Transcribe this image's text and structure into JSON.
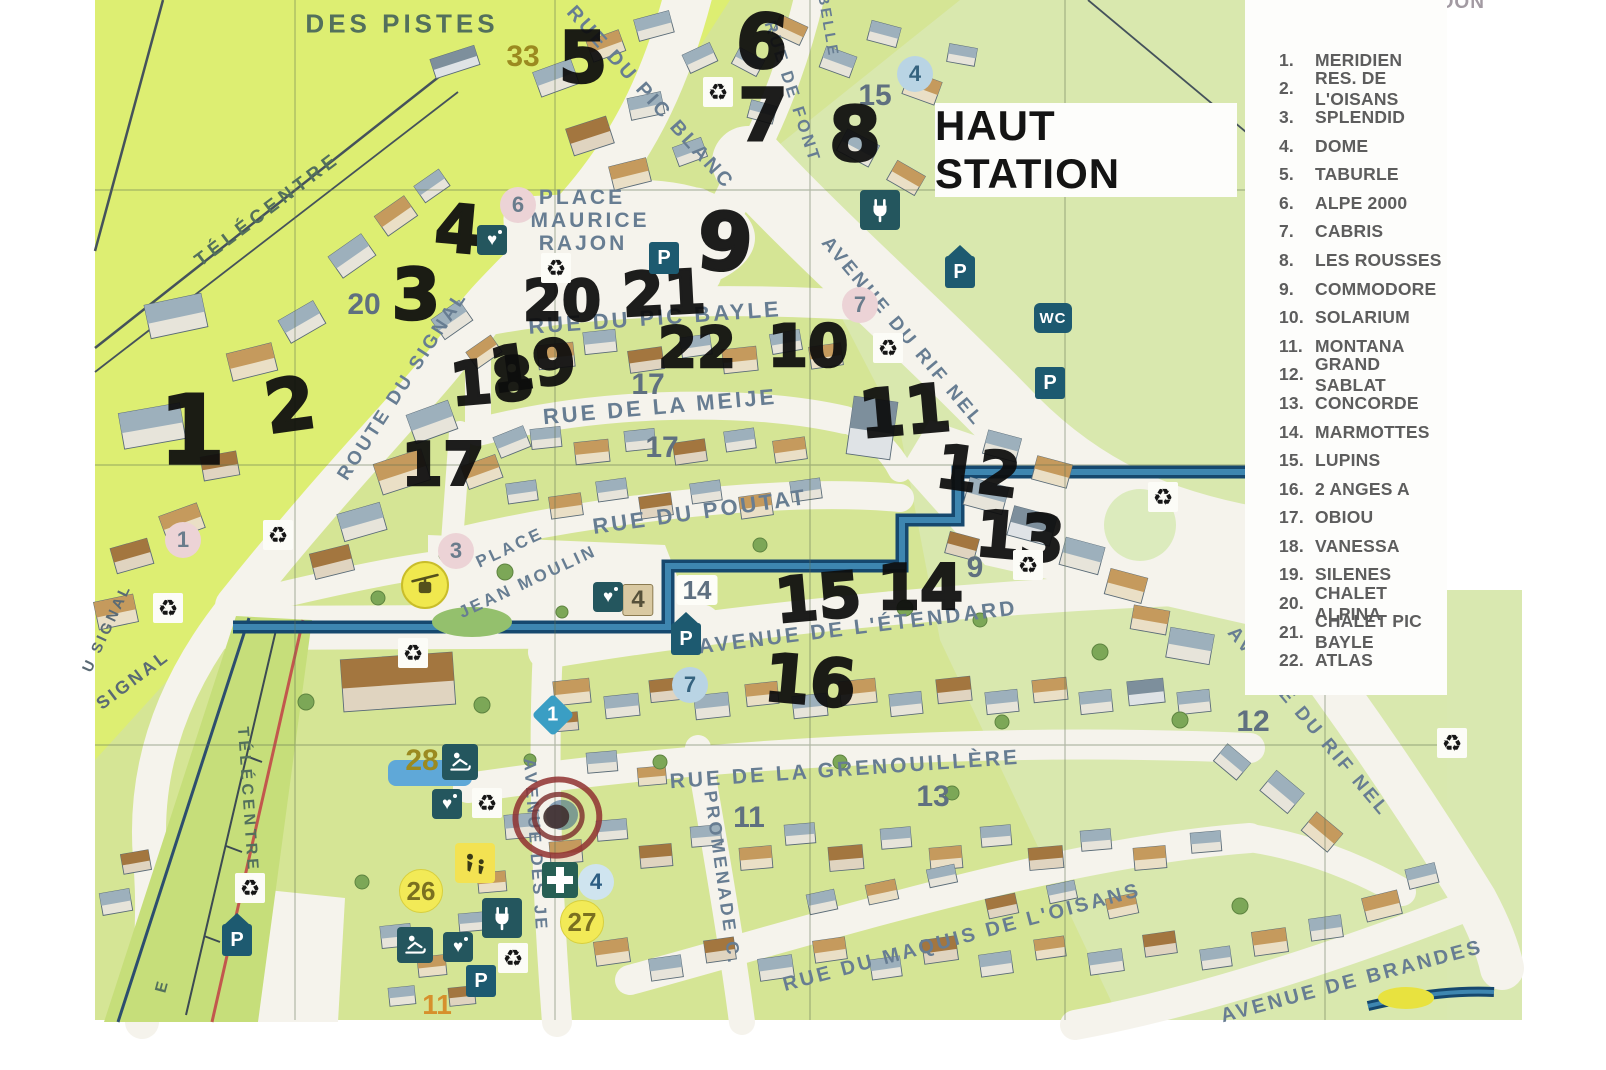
{
  "title": {
    "text": "HAUT STATION"
  },
  "agency": {
    "name": "AGENCE GIVERDON"
  },
  "legend": {
    "items": [
      {
        "n": "1.",
        "label": "MERIDIEN"
      },
      {
        "n": "2.",
        "label": "RES. DE L'OISANS"
      },
      {
        "n": "3.",
        "label": "SPLENDID"
      },
      {
        "n": "4.",
        "label": "DOME"
      },
      {
        "n": "5.",
        "label": "TABURLE"
      },
      {
        "n": "6.",
        "label": "ALPE 2000"
      },
      {
        "n": "7.",
        "label": "CABRIS"
      },
      {
        "n": "8.",
        "label": "LES ROUSSES"
      },
      {
        "n": "9.",
        "label": "COMMODORE"
      },
      {
        "n": "10.",
        "label": "SOLARIUM"
      },
      {
        "n": "11.",
        "label": "MONTANA"
      },
      {
        "n": "12.",
        "label": "GRAND SABLAT"
      },
      {
        "n": "13.",
        "label": "CONCORDE"
      },
      {
        "n": "14.",
        "label": "MARMOTTES"
      },
      {
        "n": "15.",
        "label": "LUPINS"
      },
      {
        "n": "16.",
        "label": "2 ANGES A"
      },
      {
        "n": "17.",
        "label": "OBIOU"
      },
      {
        "n": "18.",
        "label": "VANESSA"
      },
      {
        "n": "19.",
        "label": "SILENES"
      },
      {
        "n": "20.",
        "label": "CHALET ALPINA"
      },
      {
        "n": "21.",
        "label": "CHALET PIC BAYLE"
      },
      {
        "n": "22.",
        "label": "ATLAS"
      }
    ]
  },
  "labels": {
    "des_pistes": "DES PISTES",
    "telecentre_top": "TÉLÉCENTRE",
    "pic_blanc": "RUE DU PIC BLANC",
    "font": "RUE DE FONT",
    "belle": "BELLE",
    "rajon1": "PLACE",
    "rajon2": "MAURICE",
    "rajon3": "RAJON",
    "pic_bayle": "RUE DU PIC BAYLE",
    "signal": "ROUTE DU SIGNAL",
    "rifnel_upper": "AVENUE DU RIF NEL",
    "meije": "RUE DE LA MEIJE",
    "poutat": "RUE DU POUTAT",
    "jm1": "PLACE",
    "jm2": "JEAN MOULIN",
    "etendard": "AVENUE DE L'ÉTENDARD",
    "rifnel_right": "AVENUE DU RIF NEL",
    "grenouillere": "RUE DE LA GRENOUILLÈRE",
    "promenade": "PROMENADE C.",
    "jeux": "AVENUE DES JE",
    "maquis": "RUE DU MAQUIS DE L'OISANS",
    "brandes": "AVENUE DE BRANDES",
    "telecentre_v": "TÉLÉCENTRE",
    "signal_bl": "SIGNAL",
    "signal_left": "U SIGNAL",
    "e": "E"
  },
  "icon_labels": {
    "parking": "P",
    "wc": "WC"
  },
  "printed": [
    {
      "t": "33"
    },
    {
      "t": "4"
    },
    {
      "t": "15"
    },
    {
      "t": "6"
    },
    {
      "t": "20"
    },
    {
      "t": "7"
    },
    {
      "t": "17"
    },
    {
      "t": "17"
    },
    {
      "t": "1"
    },
    {
      "t": "3"
    },
    {
      "t": "9"
    },
    {
      "t": "14"
    },
    {
      "t": "4"
    },
    {
      "t": "7"
    },
    {
      "t": "1"
    },
    {
      "t": "12"
    },
    {
      "t": "28"
    },
    {
      "t": "13"
    },
    {
      "t": "11"
    },
    {
      "t": "26"
    },
    {
      "t": "4"
    },
    {
      "t": "27"
    },
    {
      "t": "11"
    }
  ],
  "hand": [
    {
      "t": "1"
    },
    {
      "t": "2"
    },
    {
      "t": "3"
    },
    {
      "t": "4"
    },
    {
      "t": "5"
    },
    {
      "t": "6"
    },
    {
      "t": "7"
    },
    {
      "t": "8"
    },
    {
      "t": "9"
    },
    {
      "t": "10"
    },
    {
      "t": "11"
    },
    {
      "t": "12"
    },
    {
      "t": "13"
    },
    {
      "t": "14"
    },
    {
      "t": "15"
    },
    {
      "t": "16"
    },
    {
      "t": "17"
    },
    {
      "t": "18"
    },
    {
      "t": "19"
    },
    {
      "t": "20"
    },
    {
      "t": "21"
    },
    {
      "t": "22"
    }
  ],
  "colors": {
    "grass": "#d5e595",
    "grass_bright": "#dff069",
    "grass_pale": "#d9e8b0",
    "road": "#f5f3ec",
    "river": "#16486e",
    "river_core": "#3e86b0",
    "icon_teal": "#24565e",
    "parking_blue": "#1d5a70",
    "marker_black": "#0d0d0d",
    "legend_text": "#5d5d5d",
    "agency_pink": "#cf5a80",
    "slope_red": "#c2574d"
  }
}
